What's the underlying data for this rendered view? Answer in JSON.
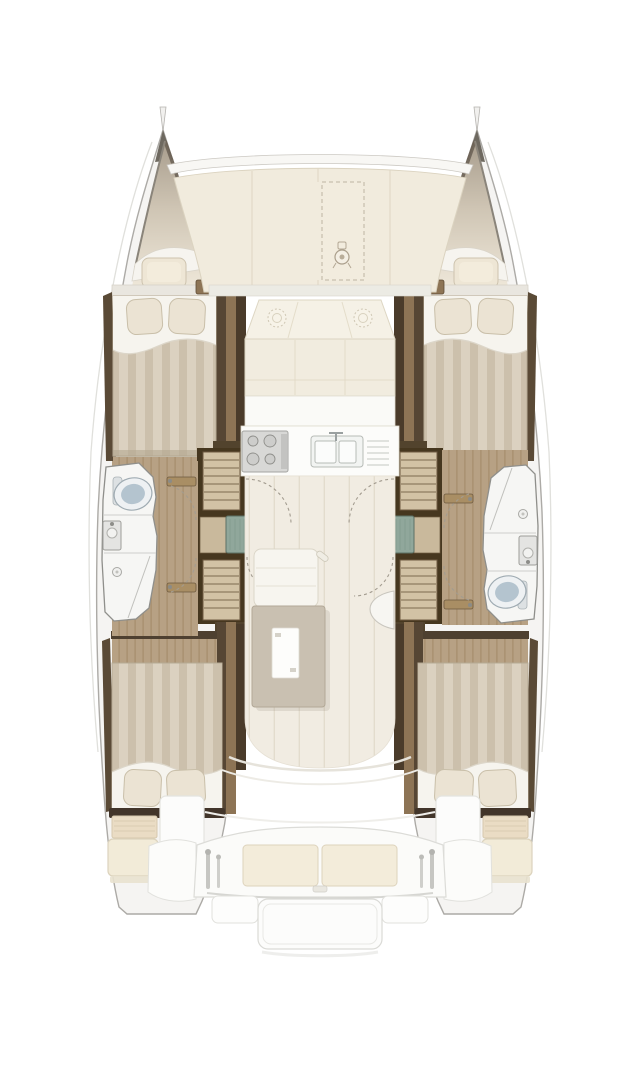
{
  "features": {
    "boat": "Catamaran deck floor plan, bow up",
    "hull_port": "Port hull: forward cabin, head with shower, aft cabin, companionway stairs",
    "hull_starboard": "Starboard hull: forward cabin, head with shower, aft cabin, companionway stairs",
    "bow_port": "Port bow with forepeak locker hatch",
    "bow_starboard": "Starboard bow with forepeak locker hatch",
    "foredeck": "Foredeck between hulls",
    "anchor_locker": "Anchor locker (dashed outline)",
    "windlass": "Anchor windlass",
    "saloon": "Saloon with forward sofa and galley",
    "sofa": "Forward U-sofa with cushions",
    "deck_hatches": "Two round deck hatches",
    "galley_stove": "Galley cooktop with four burners",
    "galley_sink": "Double galley sink with faucet and drainboard",
    "saloon_table": "Saloon table with chart sheet",
    "saloon_bench": "Saloon bench step unit",
    "nav_seat": "Curved seat at starboard saloon wall",
    "head_port": "Port bathroom: toilet, washbasin, shower",
    "head_starboard": "Starboard bathroom: shower, washbasin, toilet",
    "forward_cabin": "Double berth, pillows forward",
    "aft_cabin": "Double berth, pillows aft",
    "companionway": "Steps down into hull with landing pad",
    "helm_seat": "Aft deck helm seat",
    "cockpit_bench": "Aft cockpit bench with two cushions",
    "davits": "Dinghy davit posts",
    "transom_platform": "Central transom swim platform with side steps"
  },
  "colors": {
    "shell": "#f5f4f2",
    "shell-stroke": "#acaaa6",
    "deck-cream": "#f1ebdd",
    "deck-seam": "#ded6c3",
    "wall-dark": "#4e4030",
    "wall-outer": "#5a4a36",
    "wall-deep": "#46371f",
    "trim-tan": "#8d7455",
    "wood-floor": "#b7a184",
    "saloon-floor": "#f1ece2",
    "bed-stripe-a": "#dbd1c0",
    "bed-stripe-b": "#ccc0ac",
    "sheet-white": "#f6f4ee",
    "pillow": "#ebe3d3",
    "pillow-stroke": "#c9bfa9",
    "bath-white": "#f6f6f4",
    "bath-stroke": "#8f8f8b",
    "toilet-blue": "#b4c4cf",
    "teal-pad": "#90a79b",
    "stair-tread": "#d2c2a5",
    "stair-line": "#6d5a41",
    "table-taupe": "#c9c0b1",
    "counter-white": "#fcfcfa",
    "stove-gray": "#d8d8d6",
    "cushion-cream": "#f3ecda",
    "faint-outline": "#e0e0dc",
    "dashed-gray": "#a39c90",
    "bow-grad-top": "#a89d8d",
    "bow-grad-bottom": "#f0e9db"
  }
}
